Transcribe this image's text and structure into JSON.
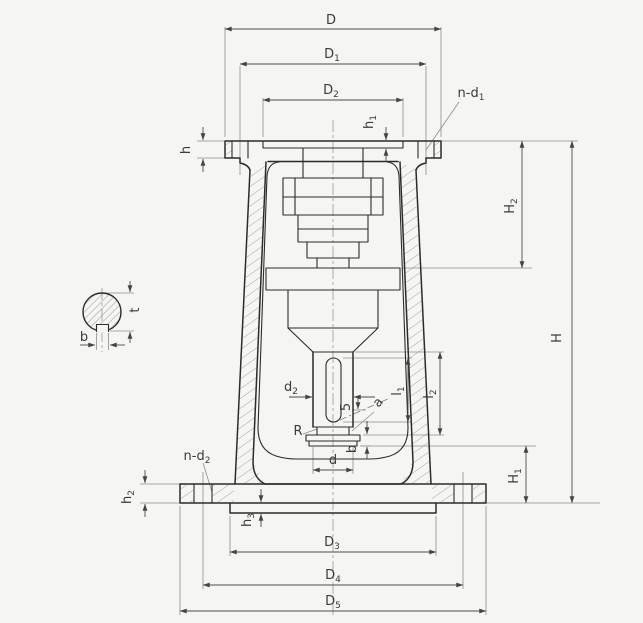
{
  "drawing": {
    "description": "Dimensioned sectional engineering drawing of a valve-actuator support bracket (yoke) with top flange, tapered legs, bottom flange, internal drive stack, output stem with slot, and a separate hatched shaft cross-section detail with keyway",
    "views": {
      "main_view": "sectioned front elevation of support bracket",
      "detail_view": "shaft cross-section with keyway"
    }
  },
  "labels": {
    "D": {
      "main": "D",
      "sub": ""
    },
    "D1": {
      "main": "D",
      "sub": "1"
    },
    "D2": {
      "main": "D",
      "sub": "2"
    },
    "D3": {
      "main": "D",
      "sub": "3"
    },
    "D4": {
      "main": "D",
      "sub": "4"
    },
    "D5": {
      "main": "D",
      "sub": "5"
    },
    "H": {
      "main": "H",
      "sub": ""
    },
    "H1": {
      "main": "H",
      "sub": "1"
    },
    "H2": {
      "main": "H",
      "sub": "2"
    },
    "h": {
      "main": "h",
      "sub": ""
    },
    "h1": {
      "main": "h",
      "sub": "1"
    },
    "h2": {
      "main": "h",
      "sub": "2"
    },
    "h3": {
      "main": "h",
      "sub": "3"
    },
    "n_d1": {
      "main": "n-d",
      "sub": "1"
    },
    "n_d2": {
      "main": "n-d",
      "sub": "2"
    },
    "l1": {
      "main": "l",
      "sub": "1"
    },
    "l2": {
      "main": "l",
      "sub": "2"
    },
    "d": {
      "main": "d",
      "sub": ""
    },
    "d2": {
      "main": "d",
      "sub": "2"
    },
    "R": {
      "main": "R",
      "sub": ""
    },
    "a": {
      "main": "a",
      "sub": ""
    },
    "five": {
      "main": "5",
      "sub": ""
    },
    "b_stem": {
      "main": "b",
      "sub": ""
    },
    "b_keyway": {
      "main": "b",
      "sub": ""
    },
    "t": {
      "main": "t",
      "sub": ""
    }
  },
  "colors": {
    "background": "#f5f5f3",
    "outline": "#2b2b2b",
    "dimension": "#4c4c4c",
    "thin_line": "#8d8d8d",
    "hatch": "#9b9b9b",
    "text": "#3a3a3a"
  }
}
